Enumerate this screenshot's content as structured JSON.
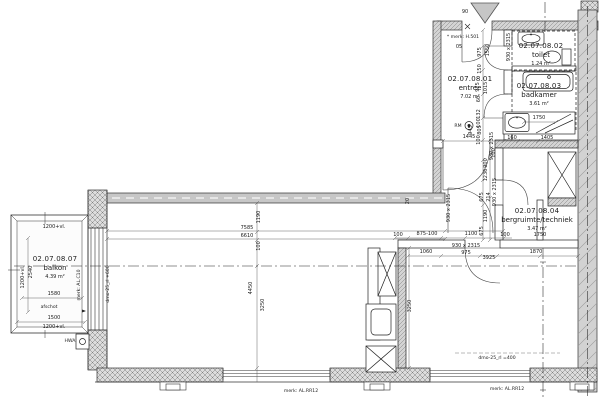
{
  "rooms": [
    {
      "id": "02.07.08.01",
      "name": "entree",
      "area": "7.02 m²",
      "x": 470,
      "y": 81
    },
    {
      "id": "02.07.08.02",
      "name": "toilet",
      "area": "1.24 m²",
      "x": 541,
      "y": 48
    },
    {
      "id": "02.07.08.03",
      "name": "badkamer",
      "area": "3.61 m²",
      "x": 539,
      "y": 88
    },
    {
      "id": "02.07.08.04",
      "name": "bergruimte/techniek",
      "area": "3.47 m²",
      "x": 537,
      "y": 213
    },
    {
      "id": "02.07.08.07",
      "name": "balkon",
      "area": "4.39 m²",
      "x": 55,
      "y": 261
    }
  ],
  "annotations": [
    {
      "t": "7585",
      "x": 247,
      "y": 229
    },
    {
      "t": "6610",
      "x": 247,
      "y": 237
    },
    {
      "t": "1190",
      "x": 260,
      "y": 217,
      "r": -90
    },
    {
      "t": "100",
      "x": 260,
      "y": 246,
      "r": -90
    },
    {
      "t": "4450",
      "x": 252,
      "y": 288,
      "r": -90
    },
    {
      "t": "3250",
      "x": 264,
      "y": 305,
      "r": -90
    },
    {
      "t": "3250",
      "x": 411,
      "y": 306,
      "r": -90
    },
    {
      "t": "20",
      "x": 409,
      "y": 201,
      "r": -90
    },
    {
      "t": "930 x 2315",
      "x": 450,
      "y": 208,
      "r": -90
    },
    {
      "t": "100",
      "x": 398,
      "y": 236
    },
    {
      "t": "875-100",
      "x": 427,
      "y": 235
    },
    {
      "t": "1100",
      "x": 471,
      "y": 235
    },
    {
      "t": "100",
      "x": 505,
      "y": 236
    },
    {
      "t": "1060",
      "x": 426,
      "y": 253
    },
    {
      "t": "930 x 2315",
      "x": 466,
      "y": 247
    },
    {
      "t": "975",
      "x": 466,
      "y": 254
    },
    {
      "t": "3925",
      "x": 489,
      "y": 259
    },
    {
      "t": "1870",
      "x": 536,
      "y": 253
    },
    {
      "t": "1750",
      "x": 540,
      "y": 236
    },
    {
      "t": "675",
      "x": 483,
      "y": 231,
      "r": -90
    },
    {
      "t": "1190",
      "x": 487,
      "y": 216,
      "r": -90
    },
    {
      "t": "930 x 2315",
      "x": 496,
      "y": 192,
      "r": -90
    },
    {
      "t": "214",
      "x": 490,
      "y": 197,
      "r": -90
    },
    {
      "t": "675",
      "x": 483,
      "y": 197,
      "r": -90
    },
    {
      "t": "1236",
      "x": 487,
      "y": 175,
      "r": -90
    },
    {
      "t": "900",
      "x": 487,
      "y": 163,
      "r": -90
    },
    {
      "t": "100",
      "x": 495,
      "y": 153,
      "r": -90
    },
    {
      "t": "1445",
      "x": 469,
      "y": 138
    },
    {
      "t": "160",
      "x": 512,
      "y": 139
    },
    {
      "t": "1405",
      "x": 547,
      "y": 139
    },
    {
      "t": "1750",
      "x": 539,
      "y": 119
    },
    {
      "t": "930 x 2315",
      "x": 493,
      "y": 146,
      "r": -90
    },
    {
      "t": "100",
      "x": 480,
      "y": 140,
      "r": -90
    },
    {
      "t": "805",
      "x": 481,
      "y": 130,
      "r": -90
    },
    {
      "t": "945",
      "x": 472,
      "y": 130,
      "r": -90
    },
    {
      "t": "132",
      "x": 480,
      "y": 114,
      "r": -90
    },
    {
      "t": "100",
      "x": 480,
      "y": 123,
      "r": -90
    },
    {
      "t": "60",
      "x": 480,
      "y": 99,
      "r": -90
    },
    {
      "t": "975",
      "x": 479,
      "y": 87,
      "r": -90
    },
    {
      "t": "1015",
      "x": 487,
      "y": 88,
      "r": -90
    },
    {
      "t": "150",
      "x": 481,
      "y": 69,
      "r": -90
    },
    {
      "t": "975",
      "x": 481,
      "y": 52,
      "r": -90
    },
    {
      "t": "1550",
      "x": 489,
      "y": 50,
      "r": -90
    },
    {
      "t": "930 x 2315",
      "x": 510,
      "y": 47,
      "r": -90
    },
    {
      "t": "1580",
      "x": 54,
      "y": 295
    },
    {
      "t": "1500",
      "x": 54,
      "y": 319
    },
    {
      "t": "1200+vl.",
      "x": 54,
      "y": 228
    },
    {
      "t": "1200+vl.",
      "x": 54,
      "y": 328
    },
    {
      "t": "1200+vl.",
      "x": 24,
      "y": 277,
      "r": -90
    },
    {
      "t": "2540",
      "x": 32,
      "y": 272,
      "r": -90
    },
    {
      "t": "90",
      "x": 465,
      "y": 13
    },
    {
      "t": "05",
      "x": 459,
      "y": 48
    },
    {
      "t": "* merk: H.501",
      "x": 463,
      "y": 38,
      "s": "m"
    },
    {
      "t": "merk: AL.C10",
      "x": 80,
      "y": 285,
      "r": -90,
      "s": "m"
    },
    {
      "t": "dmo-25_rl +600",
      "x": 109,
      "y": 284,
      "r": -90,
      "s": "m"
    },
    {
      "t": "merk: AL.RR12",
      "x": 301,
      "y": 392,
      "s": "m"
    },
    {
      "t": "merk: AL.RR12",
      "x": 507,
      "y": 390,
      "s": "m"
    },
    {
      "t": "dmo-25_rl =400",
      "x": 497,
      "y": 359,
      "s": "m"
    },
    {
      "t": "RM",
      "x": 458,
      "y": 127,
      "s": "m"
    },
    {
      "t": "afschot",
      "x": 49,
      "y": 308,
      "s": "m"
    },
    {
      "t": "HWA",
      "x": 70,
      "y": 342,
      "s": "m"
    }
  ]
}
